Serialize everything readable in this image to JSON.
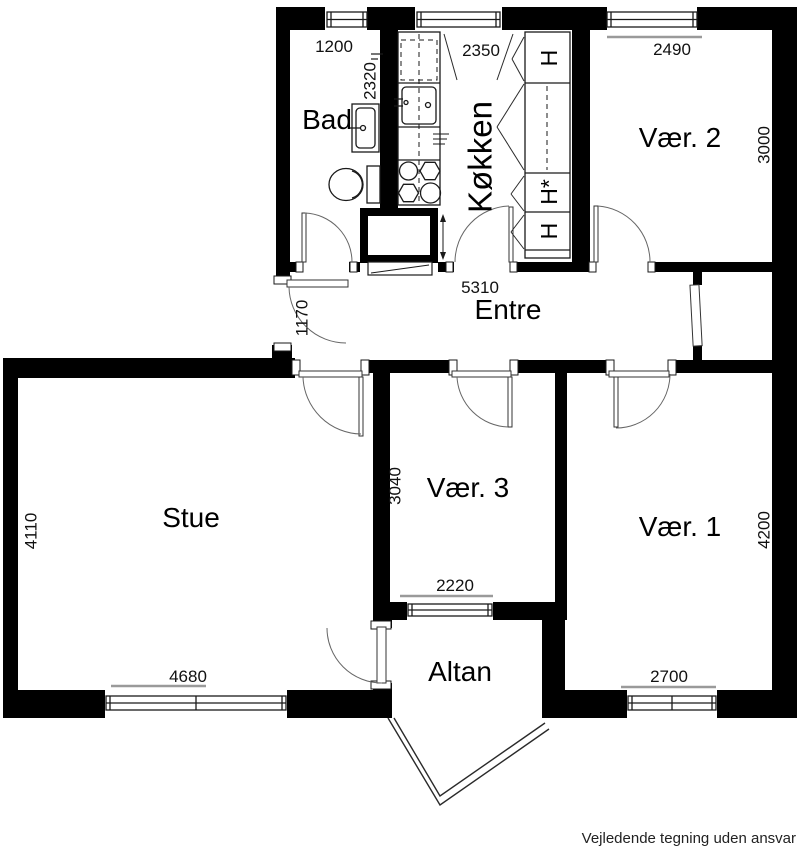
{
  "plan": {
    "disclaimer": "Vejledende tegning uden ansvar",
    "rooms": {
      "bad": "Bad",
      "kokken": "Køkken",
      "vaer2": "Vær. 2",
      "entre": "Entre",
      "stue": "Stue",
      "vaer3": "Vær. 3",
      "vaer1": "Vær. 1",
      "altan": "Altan"
    },
    "dimensions": {
      "bad_width": "1200",
      "bad_depth": "2320",
      "kokken_width": "2350",
      "vaer2_width": "2490",
      "vaer2_depth": "3000",
      "entre_width": "5310",
      "entre_niche": "1170",
      "stue_depth": "4110",
      "stue_window": "4680",
      "vaer3_depth": "3040",
      "vaer3_window": "2220",
      "vaer1_depth": "4200",
      "vaer1_window": "2700"
    },
    "kitchen_cabinets": {
      "c1": "H",
      "c2": "H*",
      "c3": "H"
    },
    "colors": {
      "wall": "#000000",
      "line": "#2a2a2a",
      "dim": "#9a9a9a",
      "bg": "#ffffff"
    }
  }
}
